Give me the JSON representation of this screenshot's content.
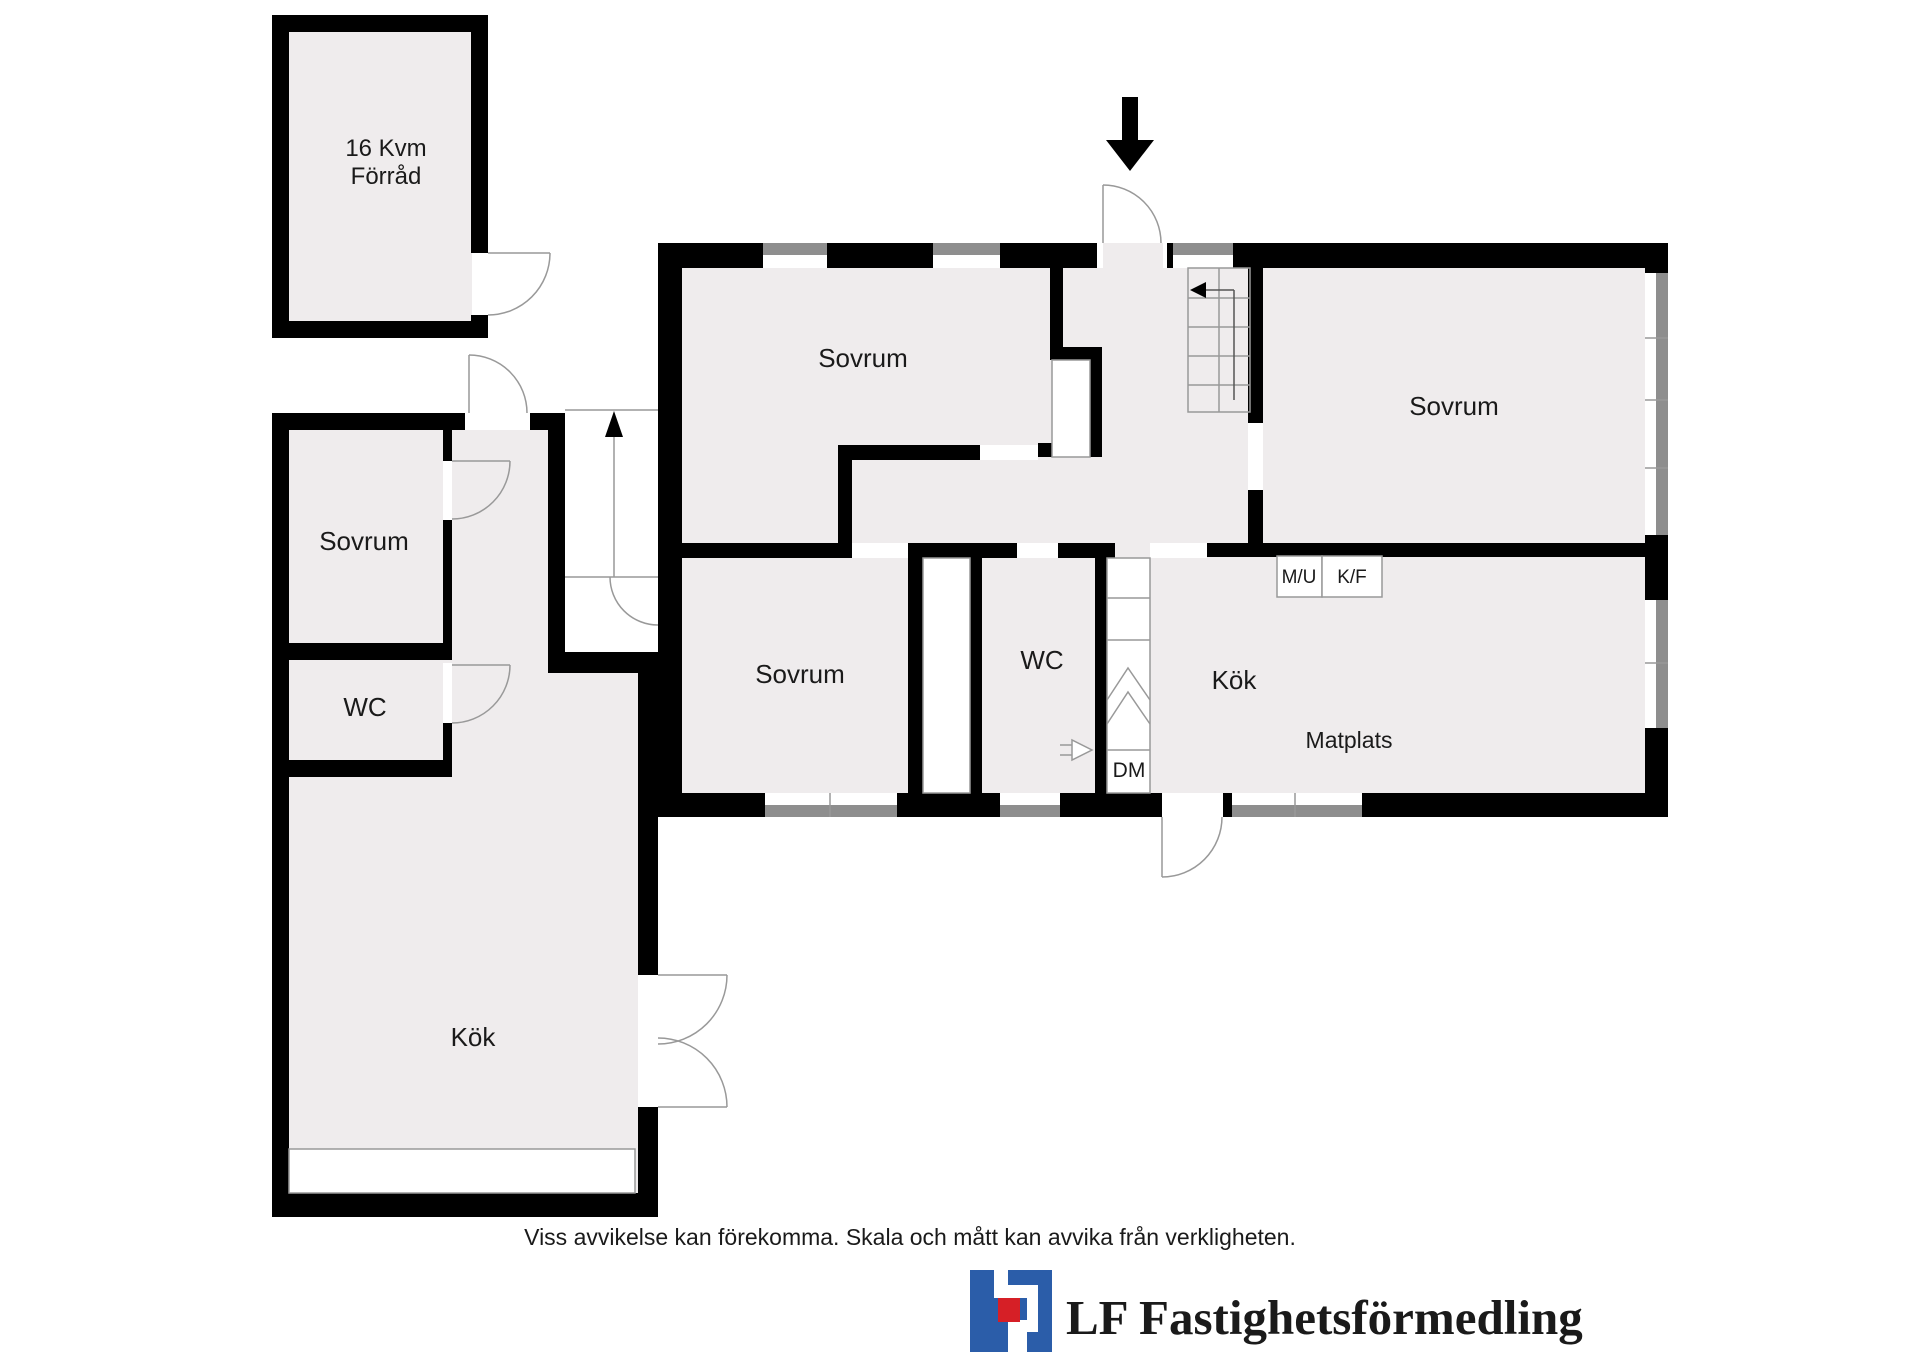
{
  "plan": {
    "storage": {
      "line1": "16 Kvm",
      "line2": "Förråd"
    },
    "left_building": {
      "bedroom": "Sovrum",
      "wc": "WC",
      "kitchen": "Kök"
    },
    "main_building": {
      "bedroom_top": "Sovrum",
      "bedroom_right": "Sovrum",
      "bedroom_bottom": "Sovrum",
      "wc": "WC",
      "kitchen": "Kök",
      "dining": "Matplats",
      "dishwasher": "DM",
      "appliance_micro_oven": "M/U",
      "appliance_fridge_freezer": "K/F"
    }
  },
  "footer": {
    "disclaimer": "Viss avvikelse kan förekomma. Skala och mått kan avvika från verkligheten."
  },
  "logo": {
    "text": "LF Fastighetsförmedling"
  },
  "colors": {
    "floor": "#efeced",
    "wall": "#000000",
    "window": "#8e8e8e",
    "thin_line": "#999999",
    "logo_blue": "#2b5da9",
    "logo_red": "#d61f26",
    "text": "#1a1a1a"
  }
}
